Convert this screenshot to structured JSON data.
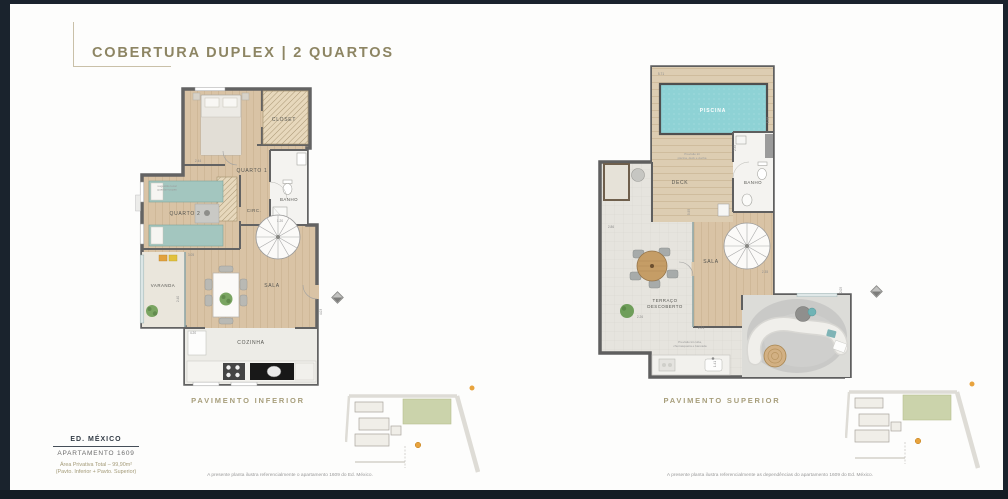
{
  "header": {
    "title": "COBERTURA DUPLEX | 2 QUARTOS"
  },
  "colors": {
    "accent": "#8d8563",
    "wall": "#636363",
    "wood": "#d9c3a5",
    "pool": "#8ed2d5",
    "frame": "#1a232d"
  },
  "plans": {
    "lower": {
      "caption": "PAVIMENTO INFERIOR",
      "disclaimer": "A presente planta ilustra referencialmente o apartamento 1609 do Ed. México.",
      "rooms": {
        "quarto1": "QUARTO 1",
        "closet": "CLOSET",
        "banho": "BANHO",
        "circ": "CIRC.",
        "quarto2": "QUARTO 2",
        "varanda": "VARANDA",
        "sala": "SALA",
        "cozinha": "COZINHA"
      },
      "notes": {
        "wardrobe_l1": "sugestão local",
        "wardrobe_l2": "guarda-roupas"
      },
      "dims": [
        "2.44",
        "3.05",
        "2.40",
        "4.20",
        "1.20",
        "4.03"
      ]
    },
    "upper": {
      "caption": "PAVIMENTO SUPERIOR",
      "disclaimer": "A presente planta ilustra referencialmente as dependências do apartamento 1609 do Ed. México.",
      "rooms": {
        "piscina": "PISCINA",
        "deck": "DECK",
        "banho": "BANHO",
        "sala": "SALA",
        "terraco_l1": "TERRAÇO",
        "terraco_l2": "DESCOBERTO"
      },
      "notes": {
        "pool_l1": "Previsão kit",
        "pool_l2": "piscina, deck e ducha",
        "bbq_l1": "Previsão kit cuba,",
        "bbq_l2": "churrasqueira e bancada"
      },
      "dims": [
        "5.71",
        "1.98",
        "2.35",
        "5.95",
        "2.86",
        "2.35",
        "2.05",
        "2.21",
        "2.26",
        "1.41"
      ]
    }
  },
  "info": {
    "building": "ED. MÉXICO",
    "apartment": "APARTAMENTO 1609",
    "area_line1": "Área Privativa Total – 99,90m²",
    "area_line2": "(Pavto. Inferior + Pavto. Superior)"
  }
}
